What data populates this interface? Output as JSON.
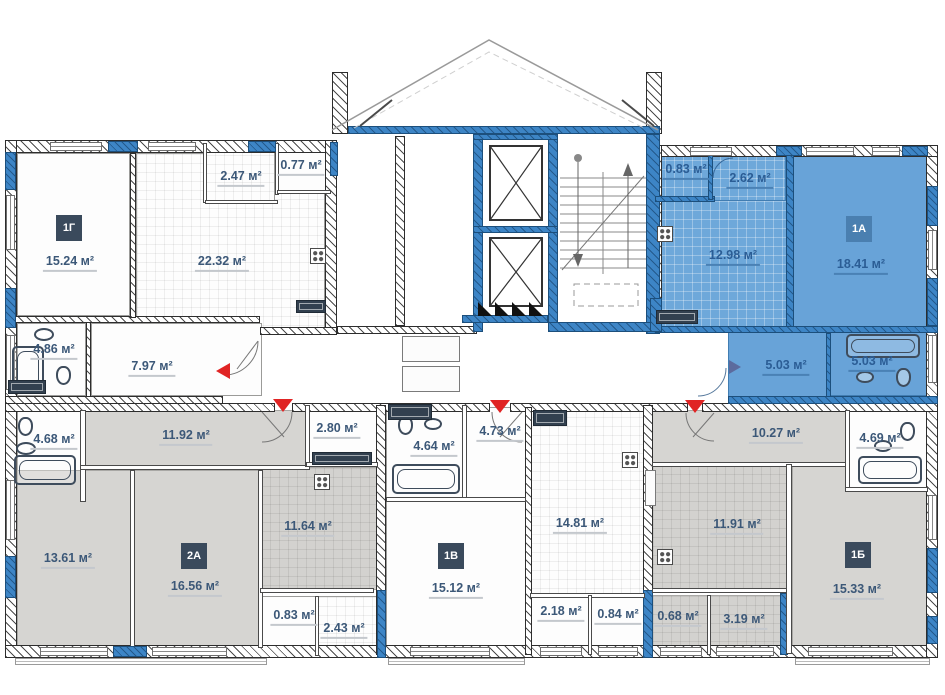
{
  "plan_title": "apartment-floor-plan",
  "colors": {
    "highlight_fill": "#68a3d8",
    "wall_blue": "#3d85c6",
    "room_gray": "#d6d5d2",
    "label": "#3c5878",
    "label_on_blue": "#2b5d95",
    "badge_bg": "#3a4a5c",
    "badge_on_blue_bg": "#4a7fb0",
    "entrance_marker_red": "#e02424",
    "entrance_marker_blue": "#5c6b9e"
  },
  "core": {
    "elevator_count": 2,
    "staircase": true
  },
  "apartments": [
    {
      "id": "1G",
      "badge": "1Г",
      "highlighted": false,
      "badge_pos": {
        "x": 56,
        "y": 215
      },
      "rooms": [
        {
          "name": "living-room",
          "area": "15.24 м²",
          "x": 17,
          "y": 153,
          "w": 113,
          "h": 163,
          "fill": "white",
          "lx": 70,
          "ly": 264
        },
        {
          "name": "kitchen",
          "area": "22.32 м²",
          "x": 136,
          "y": 153,
          "w": 189,
          "h": 177,
          "fill": "white-grid",
          "lx": 222,
          "ly": 264
        },
        {
          "name": "balcony-1",
          "area": "2.47 м²",
          "x": 205,
          "y": 145,
          "w": 70,
          "h": 57,
          "fill": "white-grid",
          "lx": 241,
          "ly": 179
        },
        {
          "name": "balcony-2",
          "area": "0.77 м²",
          "x": 277,
          "y": 145,
          "w": 54,
          "h": 47,
          "fill": "white",
          "lx": 301,
          "ly": 168
        },
        {
          "name": "bathroom",
          "area": "4.86 м²",
          "x": 17,
          "y": 323,
          "w": 69,
          "h": 73,
          "fill": "white",
          "lx": 54,
          "ly": 352
        },
        {
          "name": "hallway",
          "area": "7.97 м²",
          "x": 91,
          "y": 323,
          "w": 171,
          "h": 73,
          "fill": "white",
          "lx": 152,
          "ly": 369
        }
      ]
    },
    {
      "id": "1A",
      "badge": "1А",
      "highlighted": true,
      "badge_pos": {
        "x": 846,
        "y": 216
      },
      "rooms": [
        {
          "name": "balcony-1",
          "area": "0.83 м²",
          "x": 655,
          "y": 150,
          "w": 55,
          "h": 48,
          "fill": "blue-grid",
          "lx": 686,
          "ly": 172
        },
        {
          "name": "balcony-2",
          "area": "2.62 м²",
          "x": 710,
          "y": 150,
          "w": 76,
          "h": 53,
          "fill": "blue-grid",
          "lx": 750,
          "ly": 181
        },
        {
          "name": "kitchen",
          "area": "12.98 м²",
          "x": 655,
          "y": 200,
          "w": 133,
          "h": 130,
          "fill": "blue-grid",
          "lx": 733,
          "ly": 258
        },
        {
          "name": "living-room",
          "area": "18.41 м²",
          "x": 792,
          "y": 150,
          "w": 146,
          "h": 180,
          "fill": "blue",
          "lx": 861,
          "ly": 267
        },
        {
          "name": "hallway",
          "area": "5.03 м²",
          "x": 728,
          "y": 330,
          "w": 100,
          "h": 72,
          "fill": "blue",
          "lx": 786,
          "ly": 368
        },
        {
          "name": "bathroom",
          "area": "5.03 м²",
          "x": 828,
          "y": 330,
          "w": 110,
          "h": 66,
          "fill": "blue",
          "lx": 872,
          "ly": 364
        }
      ]
    },
    {
      "id": "2A",
      "badge": "2А",
      "highlighted": false,
      "badge_pos": {
        "x": 181,
        "y": 543
      },
      "rooms": [
        {
          "name": "hallway",
          "area": "11.92 м²",
          "x": 80,
          "y": 410,
          "w": 228,
          "h": 57,
          "fill": "gray",
          "lx": 186,
          "ly": 438
        },
        {
          "name": "wc",
          "area": "2.80 м²",
          "x": 306,
          "y": 407,
          "w": 72,
          "h": 58,
          "fill": "white",
          "lx": 337,
          "ly": 431
        },
        {
          "name": "bathroom",
          "area": "4.68 м²",
          "x": 17,
          "y": 408,
          "w": 66,
          "h": 94,
          "fill": "white",
          "lx": 54,
          "ly": 442
        },
        {
          "name": "bedroom",
          "area": "13.61 м²",
          "x": 17,
          "y": 470,
          "w": 115,
          "h": 177,
          "fill": "gray",
          "lx": 68,
          "ly": 561
        },
        {
          "name": "living-room",
          "area": "16.56 м²",
          "x": 133,
          "y": 470,
          "w": 127,
          "h": 178,
          "fill": "gray",
          "lx": 195,
          "ly": 589
        },
        {
          "name": "kitchen",
          "area": "11.64 м²",
          "x": 260,
          "y": 467,
          "w": 118,
          "h": 123,
          "fill": "gray-grid",
          "lx": 308,
          "ly": 529
        },
        {
          "name": "balcony-1",
          "area": "0.83 м²",
          "x": 260,
          "y": 596,
          "w": 57,
          "h": 60,
          "fill": "white",
          "lx": 294,
          "ly": 618
        },
        {
          "name": "balcony-2",
          "area": "2.43 м²",
          "x": 317,
          "y": 596,
          "w": 61,
          "h": 62,
          "fill": "white-grid",
          "lx": 344,
          "ly": 631
        }
      ]
    },
    {
      "id": "1V",
      "badge": "1В",
      "highlighted": false,
      "badge_pos": {
        "x": 438,
        "y": 543
      },
      "rooms": [
        {
          "name": "bathroom",
          "area": "4.64 м²",
          "x": 386,
          "y": 405,
          "w": 78,
          "h": 94,
          "fill": "white",
          "lx": 434,
          "ly": 449
        },
        {
          "name": "hallway",
          "area": "4.73 м²",
          "x": 464,
          "y": 407,
          "w": 63,
          "h": 93,
          "fill": "white",
          "lx": 500,
          "ly": 434
        },
        {
          "name": "living-room",
          "area": "15.12 м²",
          "x": 386,
          "y": 499,
          "w": 141,
          "h": 150,
          "fill": "white",
          "lx": 456,
          "ly": 591
        },
        {
          "name": "kitchen",
          "area": "14.81 м²",
          "x": 530,
          "y": 407,
          "w": 115,
          "h": 188,
          "fill": "white-grid",
          "lx": 580,
          "ly": 526
        },
        {
          "name": "balcony-1",
          "area": "2.18 м²",
          "x": 530,
          "y": 595,
          "w": 59,
          "h": 55,
          "fill": "white",
          "lx": 561,
          "ly": 614
        },
        {
          "name": "balcony-2",
          "area": "0.84 м²",
          "x": 589,
          "y": 595,
          "w": 56,
          "h": 58,
          "fill": "white",
          "lx": 618,
          "ly": 617
        }
      ]
    },
    {
      "id": "1B",
      "badge": "1Б",
      "highlighted": false,
      "badge_pos": {
        "x": 845,
        "y": 542
      },
      "rooms": [
        {
          "name": "hallway",
          "area": "10.27 м²",
          "x": 652,
          "y": 410,
          "w": 194,
          "h": 54,
          "fill": "gray",
          "lx": 776,
          "ly": 436
        },
        {
          "name": "living-room",
          "area": "15.33 м²",
          "x": 792,
          "y": 464,
          "w": 137,
          "h": 185,
          "fill": "gray",
          "lx": 857,
          "ly": 592
        },
        {
          "name": "kitchen",
          "area": "11.91 м²",
          "x": 652,
          "y": 464,
          "w": 135,
          "h": 126,
          "fill": "gray-grid",
          "lx": 737,
          "ly": 527
        },
        {
          "name": "bathroom",
          "area": "4.69 м²",
          "x": 848,
          "y": 410,
          "w": 80,
          "h": 79,
          "fill": "white",
          "lx": 880,
          "ly": 441
        },
        {
          "name": "balcony-1",
          "area": "0.68 м²",
          "x": 652,
          "y": 595,
          "w": 56,
          "h": 55,
          "fill": "gray-grid",
          "lx": 678,
          "ly": 619
        },
        {
          "name": "balcony-2",
          "area": "3.19 м²",
          "x": 709,
          "y": 595,
          "w": 72,
          "h": 58,
          "fill": "gray-grid",
          "lx": 744,
          "ly": 622
        }
      ]
    }
  ],
  "entrance_markers": [
    {
      "apartment": "1Г",
      "dir": "left",
      "color": "red",
      "x": 216,
      "y": 363
    },
    {
      "apartment": "2А",
      "dir": "down",
      "color": "red",
      "x": 273,
      "y": 399
    },
    {
      "apartment": "1В",
      "dir": "down",
      "color": "red",
      "x": 490,
      "y": 400
    },
    {
      "apartment": "1Б",
      "dir": "down",
      "color": "red",
      "x": 685,
      "y": 400
    },
    {
      "apartment": "1А",
      "dir": "right",
      "color": "blue",
      "x": 729,
      "y": 360
    }
  ]
}
